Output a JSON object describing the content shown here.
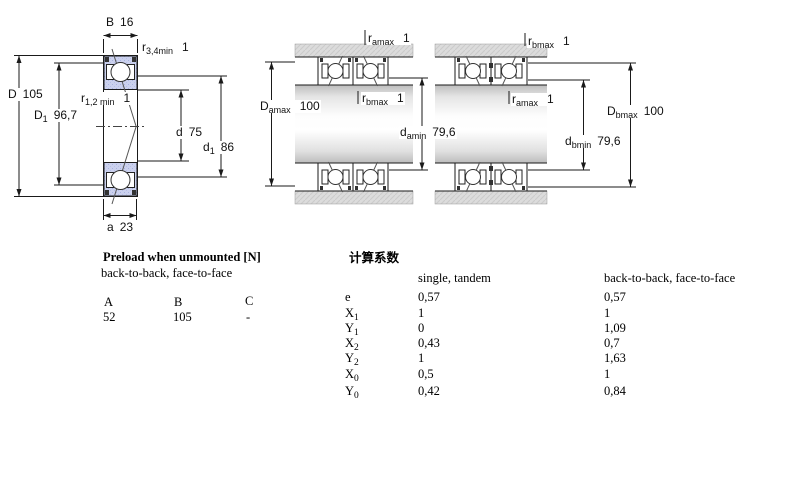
{
  "colors": {
    "bearing_section_fill": "#cbd1ee",
    "housing_fill": "#dcdcdc",
    "line": "#1a1a1a",
    "background": "#ffffff"
  },
  "diagram_left": {
    "labels": {
      "B": {
        "base": "B",
        "sub": "",
        "value": "16"
      },
      "r34": {
        "base": "r",
        "sub": "3,4min",
        "value": "1"
      },
      "D": {
        "base": "D",
        "sub": "",
        "value": "105"
      },
      "r12": {
        "base": "r",
        "sub": "1,2 min",
        "value": "1"
      },
      "D1": {
        "base": "D",
        "sub": "1",
        "value": "96,7"
      },
      "d": {
        "base": "d",
        "sub": "",
        "value": "75"
      },
      "d1": {
        "base": "d",
        "sub": "1",
        "value": "86"
      },
      "a": {
        "base": "a",
        "sub": "",
        "value": "23"
      }
    }
  },
  "diagram_middle": {
    "labels": {
      "ramax": {
        "base": "r",
        "sub": "amax",
        "value": "1"
      },
      "Damax": {
        "base": "D",
        "sub": "amax",
        "value": "100"
      },
      "rbmax": {
        "base": "r",
        "sub": "bmax",
        "value": "1"
      },
      "damin": {
        "base": "d",
        "sub": "amin",
        "value": "79,6"
      }
    }
  },
  "diagram_right": {
    "labels": {
      "rbmax": {
        "base": "r",
        "sub": "bmax",
        "value": "1"
      },
      "ramax": {
        "base": "r",
        "sub": "amax",
        "value": "1"
      },
      "Dbmax": {
        "base": "D",
        "sub": "bmax",
        "value": "100"
      },
      "dbmin": {
        "base": "d",
        "sub": "bmin",
        "value": "79,6"
      }
    }
  },
  "preload_table": {
    "title": "Preload when unmounted [N]",
    "subtitle": "back-to-back, face-to-face",
    "columns": [
      "A",
      "B",
      "C"
    ],
    "values": [
      "52",
      "105",
      "-"
    ]
  },
  "factors_table": {
    "title": "计算系数",
    "col1_header": "single, tandem",
    "col2_header": "back-to-back, face-to-face",
    "rows": [
      {
        "base": "e",
        "sub": "",
        "single_tandem": "0,57",
        "btb_ftf": "0,57"
      },
      {
        "base": "X",
        "sub": "1",
        "single_tandem": "1",
        "btb_ftf": "1"
      },
      {
        "base": "Y",
        "sub": "1",
        "single_tandem": "0",
        "btb_ftf": "1,09"
      },
      {
        "base": "X",
        "sub": "2",
        "single_tandem": "0,43",
        "btb_ftf": "0,7"
      },
      {
        "base": "Y",
        "sub": "2",
        "single_tandem": "1",
        "btb_ftf": "1,63"
      },
      {
        "base": "X",
        "sub": "0",
        "single_tandem": "0,5",
        "btb_ftf": "1"
      },
      {
        "base": "Y",
        "sub": "0",
        "single_tandem": "0,42",
        "btb_ftf": "0,84"
      }
    ]
  }
}
